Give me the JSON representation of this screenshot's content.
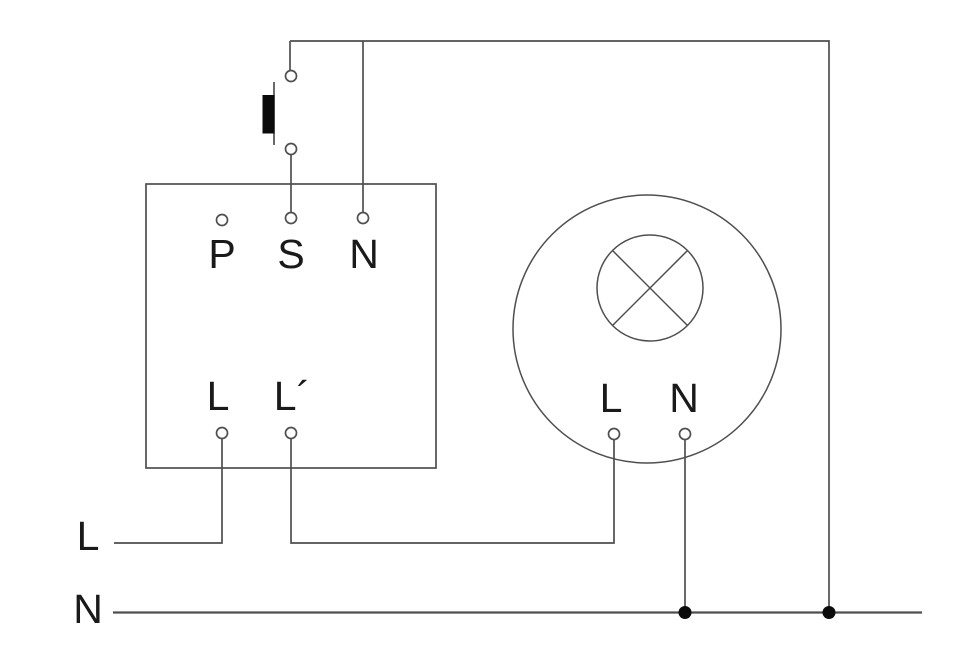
{
  "theme": {
    "background": "#ffffff",
    "line_color": "#4f4f4f",
    "text_color": "#1a1a1a",
    "dot_color": "#0b0b0b"
  },
  "diagram": {
    "title": "Wiring diagram: sensor switch with push-button and luminaire",
    "sensor_box": {
      "top_terminals": [
        {
          "label": "P"
        },
        {
          "label": "S"
        },
        {
          "label": "N"
        }
      ],
      "bottom_terminals": [
        {
          "label": "L"
        },
        {
          "label": "L´"
        }
      ]
    },
    "luminaire": {
      "terminals": [
        {
          "label": "L"
        },
        {
          "label": "N"
        }
      ]
    },
    "supply": {
      "live_label": "L",
      "neutral_label": "N"
    }
  }
}
